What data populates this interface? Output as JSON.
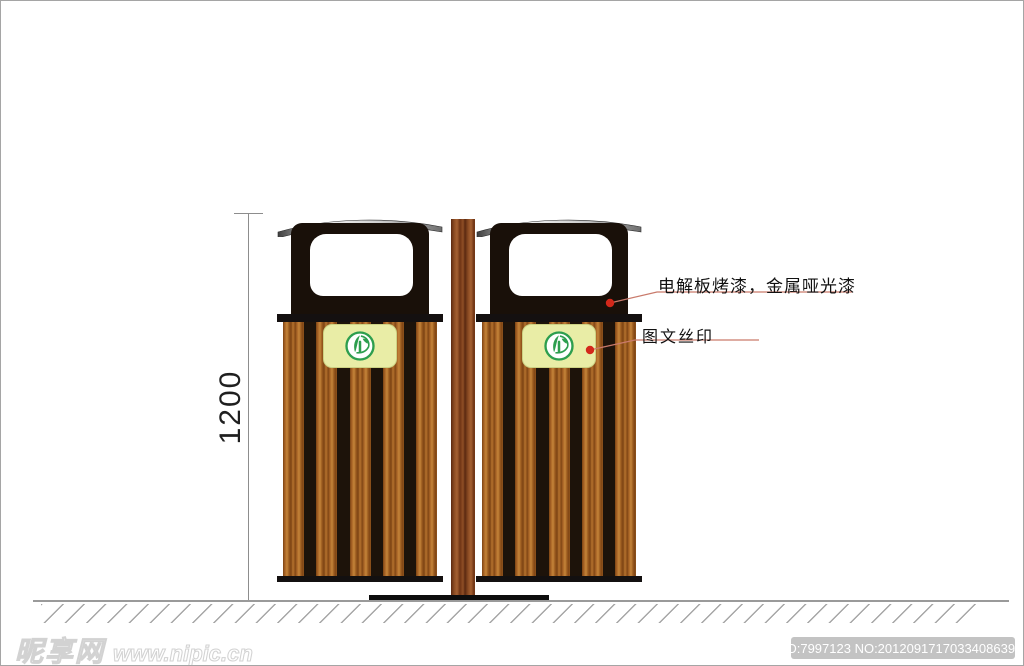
{
  "dimension": {
    "label": "1200"
  },
  "callouts": [
    {
      "text": "电解板烤漆，金属哑光漆"
    },
    {
      "text": "图文丝印"
    }
  ],
  "watermark": {
    "site_name": "昵享网",
    "site_url": "www.nipic.cn",
    "id_text": "ID:7997123 NO:20120917170334086396"
  },
  "icons": {
    "bin_logo": "green-eco-tree-logo"
  },
  "colors": {
    "frame_black": "#191009",
    "wood": "#a96526",
    "pole_wood": "#8a4a22",
    "plaque": "#e9eda6",
    "logo_green": "#2d9e4e",
    "leader_line": "#c97a6b",
    "callout_dot": "#d3281a",
    "metal_light": "#f2f2f2",
    "metal_dark": "#3f3f3f",
    "ground_gray": "#9a9a9a"
  }
}
